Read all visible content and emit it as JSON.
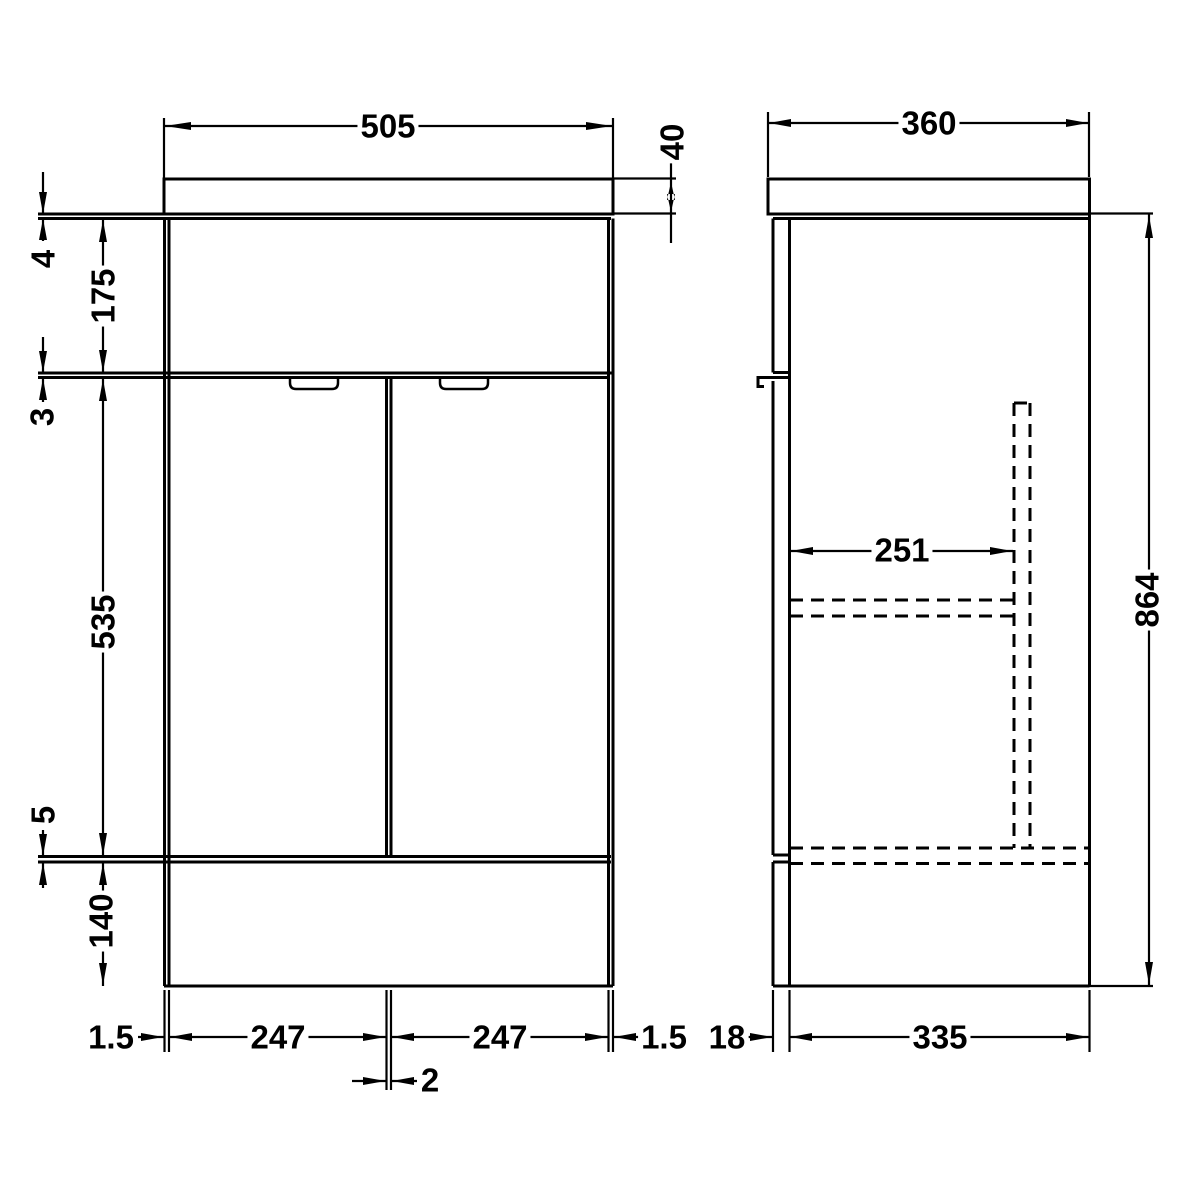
{
  "drawing": {
    "background_color": "#ffffff",
    "line_color": "#000000",
    "front_view": {
      "labels": {
        "worktop_width": "505",
        "worktop_thickness": "40",
        "worktop_to_carcass_gap": "4",
        "upper_panel_height": "175",
        "panel_to_door_gap": "3",
        "door_height": "535",
        "door_to_plinth_gap": "5",
        "plinth_height": "140",
        "left_side_reveal": "1.5",
        "left_door_width": "247",
        "right_door_width": "247",
        "right_side_reveal": "1.5",
        "door_gap": "2"
      }
    },
    "side_view": {
      "labels": {
        "worktop_depth": "360",
        "internal_depth": "251",
        "overall_height": "864",
        "door_thickness": "18",
        "carcass_depth": "335"
      }
    }
  }
}
